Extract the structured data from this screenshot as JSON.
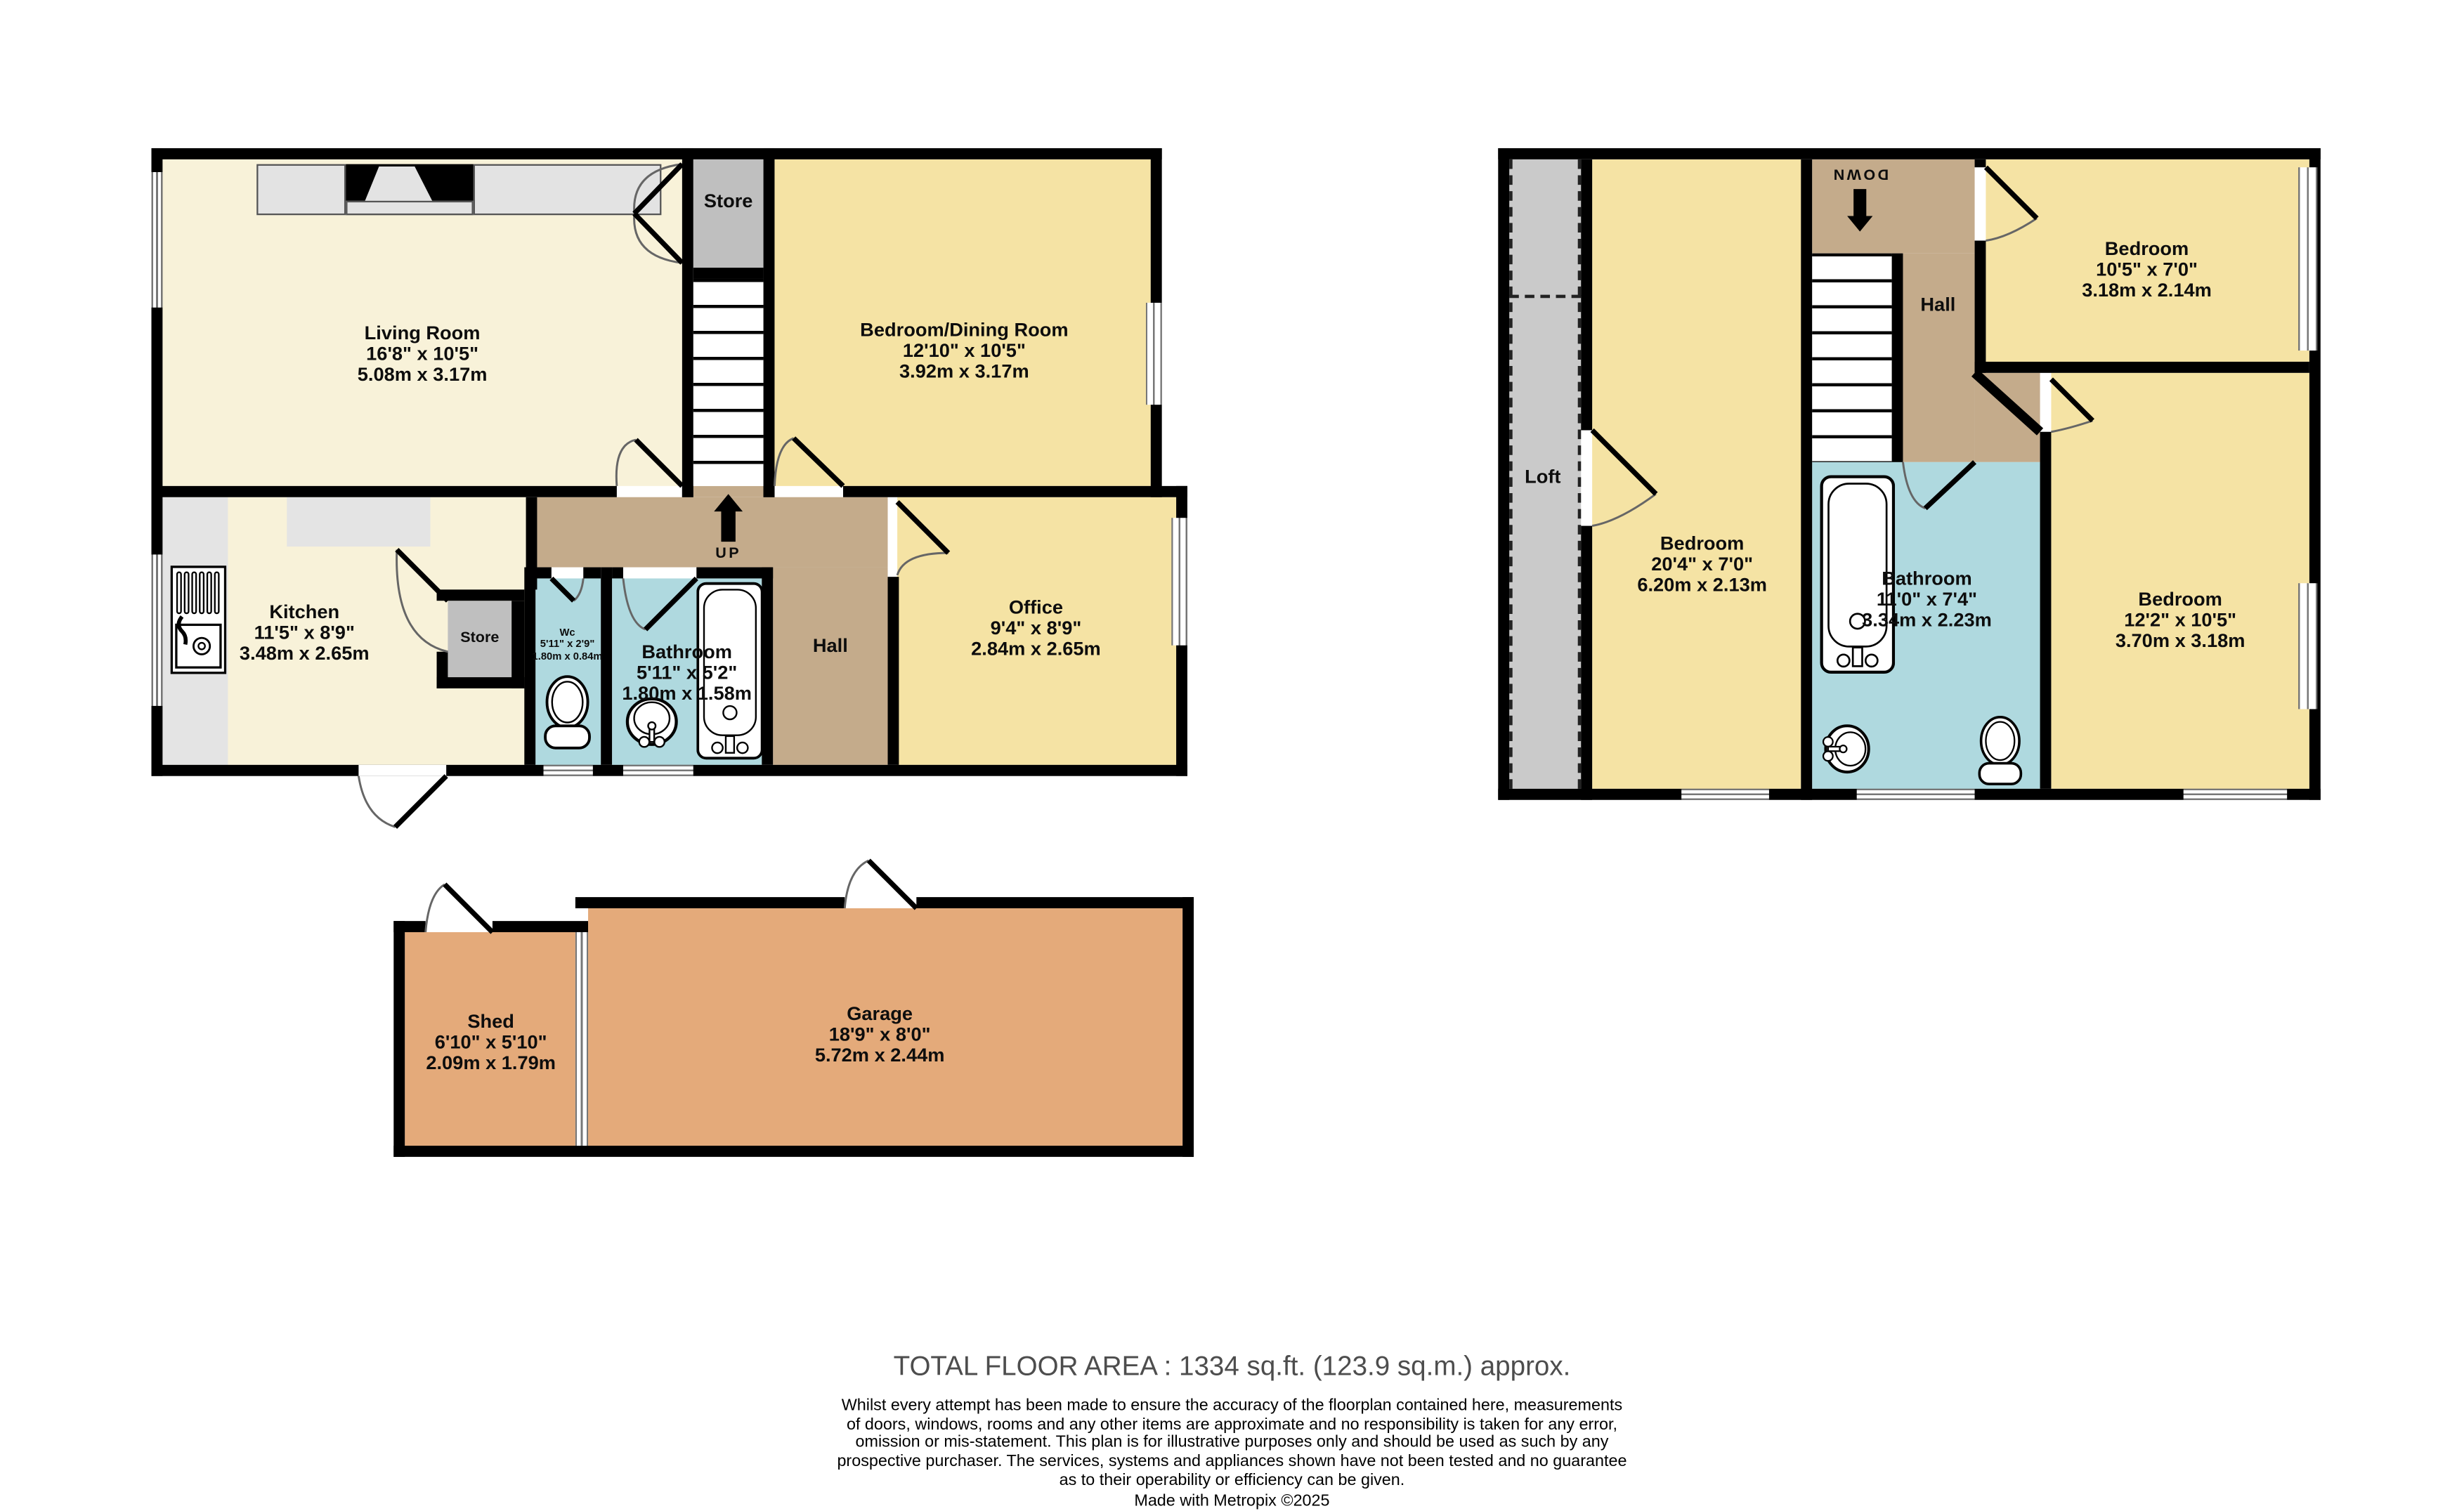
{
  "colors": {
    "wall": "#000000",
    "cream": "#F8F2D9",
    "yellow": "#F5E3A4",
    "blue": "#AFD9DF",
    "hall_tan": "#C4AB8B",
    "store_gray": "#BFBFBF",
    "loft_gray": "#CACACA",
    "counter_gray": "#E4E4E4",
    "outbuilding_orange": "#E4AA7A",
    "total_text": "#4D4D4D"
  },
  "ground_floor": {
    "living_room": {
      "name": "Living Room",
      "imperial": "16'8\"  x 10'5\"",
      "metric": "5.08m  x 3.17m"
    },
    "bedroom_dining": {
      "name": "Bedroom/Dining Room",
      "imperial": "12'10\"  x 10'5\"",
      "metric": "3.92m  x 3.17m"
    },
    "kitchen": {
      "name": "Kitchen",
      "imperial": "11'5\"  x 8'9\"",
      "metric": "3.48m  x 2.65m"
    },
    "office": {
      "name": "Office",
      "imperial": "9'4\"  x 8'9\"",
      "metric": "2.84m  x 2.65m"
    },
    "bathroom": {
      "name": "Bathroom",
      "imperial": "5'11\"  x 5'2\"",
      "metric": "1.80m  x 1.58m"
    },
    "wc": {
      "name": "Wc",
      "imperial": "5'11\"  x 2'9\"",
      "metric": "1.80m  x 0.84m"
    },
    "store_top": {
      "name": "Store"
    },
    "store_small": {
      "name": "Store"
    },
    "hall": {
      "name": "Hall"
    },
    "up_label": "UP"
  },
  "first_floor": {
    "loft": {
      "name": "Loft"
    },
    "bedroom_left": {
      "name": "Bedroom",
      "imperial": "20'4\"  x 7'0\"",
      "metric": "6.20m  x 2.13m"
    },
    "bedroom_top_right": {
      "name": "Bedroom",
      "imperial": "10'5\"  x 7'0\"",
      "metric": "3.18m  x 2.14m"
    },
    "bedroom_bottom_right": {
      "name": "Bedroom",
      "imperial": "12'2\"  x 10'5\"",
      "metric": "3.70m  x 3.18m"
    },
    "bathroom": {
      "name": "Bathroom",
      "imperial": "11'0\"  x 7'4\"",
      "metric": "3.34m  x 2.23m"
    },
    "hall": {
      "name": "Hall"
    },
    "down_label": "DOWN"
  },
  "outbuildings": {
    "shed": {
      "name": "Shed",
      "imperial": "6'10\"  x 5'10\"",
      "metric": "2.09m  x 1.79m"
    },
    "garage": {
      "name": "Garage",
      "imperial": "18'9\"  x 8'0\"",
      "metric": "5.72m  x 2.44m"
    }
  },
  "footer": {
    "total_area": "TOTAL FLOOR AREA : 1334 sq.ft. (123.9 sq.m.) approx.",
    "disclaimer": [
      "Whilst every attempt has been made to ensure the accuracy of the floorplan contained here, measurements",
      "of doors, windows, rooms and any other items are approximate and no responsibility is taken for any error,",
      "omission or mis-statement. This plan is for illustrative purposes only and should be used as such by any",
      "prospective purchaser. The services, systems and appliances shown have not been tested and no guarantee",
      "as to their operability or efficiency can be given."
    ],
    "credit": "Made with Metropix ©2025"
  }
}
